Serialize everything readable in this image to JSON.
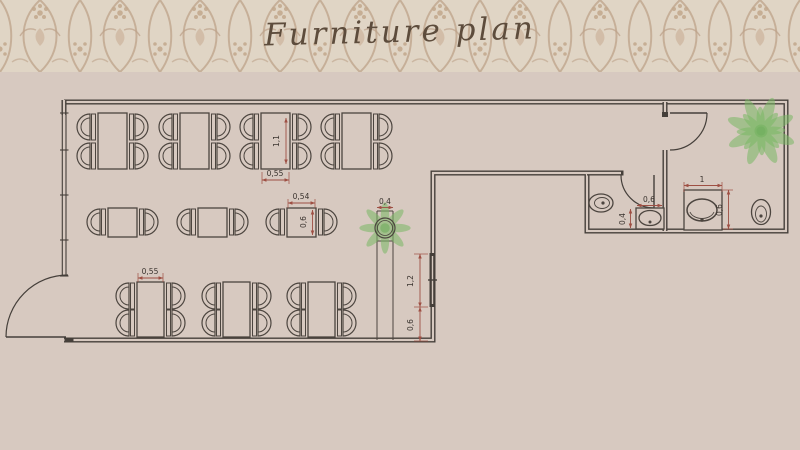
{
  "header": {
    "title": "Furniture plan"
  },
  "plan": {
    "dimensions": [
      {
        "name": "top-table-length",
        "label": "1,1"
      },
      {
        "name": "top-table-width",
        "label": "0,55"
      },
      {
        "name": "small-table-width",
        "label": "0,54"
      },
      {
        "name": "small-table-depth",
        "label": "0,6"
      },
      {
        "name": "bottom-table-width",
        "label": "0,55"
      },
      {
        "name": "planter-width",
        "label": "0,4"
      },
      {
        "name": "window-length",
        "label": "1,2"
      },
      {
        "name": "window-offset",
        "label": "0,6"
      },
      {
        "name": "wc-sink-width",
        "label": "0,6"
      },
      {
        "name": "wc-sink-depth",
        "label": "0,4"
      },
      {
        "name": "restroom-sink-width",
        "label": "1"
      },
      {
        "name": "restroom-sink-depth",
        "label": "0,6"
      }
    ],
    "colors": {
      "background": "#d7c9c0",
      "header_base": "#e0d5c5",
      "header_ornament": "#bda289",
      "wall": "#453f3a",
      "dimension": "#9e4f43",
      "plant": "#7ab865"
    }
  }
}
